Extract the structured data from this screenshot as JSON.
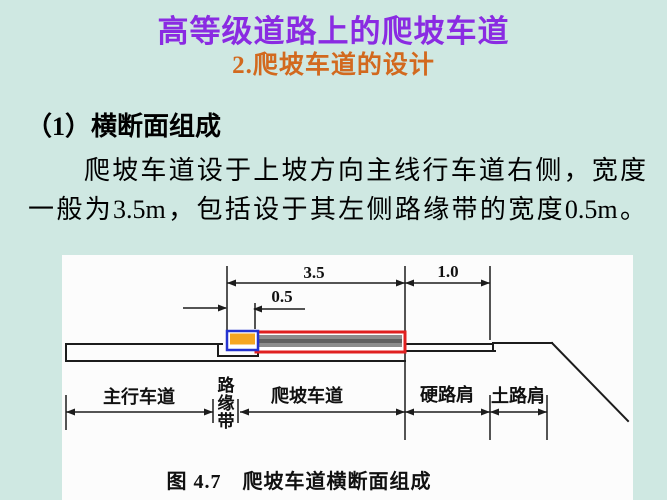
{
  "slide": {
    "title": "高等级道路上的爬坡车道",
    "subtitle": "2.爬坡车道的设计",
    "section_heading": "（1）横断面组成",
    "paragraph_line1": "爬坡车道设于上坡方向主线行车道右侧，宽度",
    "paragraph_line2": "一般为3.5m，包括设于其左侧路缘带的宽度0.5m。"
  },
  "figure": {
    "caption": "图 4.7　爬坡车道横断面组成",
    "dim_climbing_lane": "3.5",
    "dim_hard_shoulder": "1.0",
    "dim_curb_strip": "0.5",
    "label_main_lane": "主行车道",
    "label_curb_char1": "路",
    "label_curb_char2": "缘",
    "label_curb_char3": "带",
    "label_climbing_lane": "爬坡车道",
    "label_hard_shoulder": "硬路肩",
    "label_soil_shoulder": "土路肩"
  },
  "colors": {
    "background": "#cfe8e2",
    "title": "#8a2be2",
    "subtitle": "#d2691e",
    "body_text": "#000000",
    "panel": "#fcfcfc",
    "line": "#1c1c1c",
    "curb_fill": "#f5a623",
    "curb_border": "#2433cf",
    "lane_border": "#e02020",
    "lane_fill": "#8c8c8c",
    "lane_fill_dark": "#5f5f5f"
  }
}
